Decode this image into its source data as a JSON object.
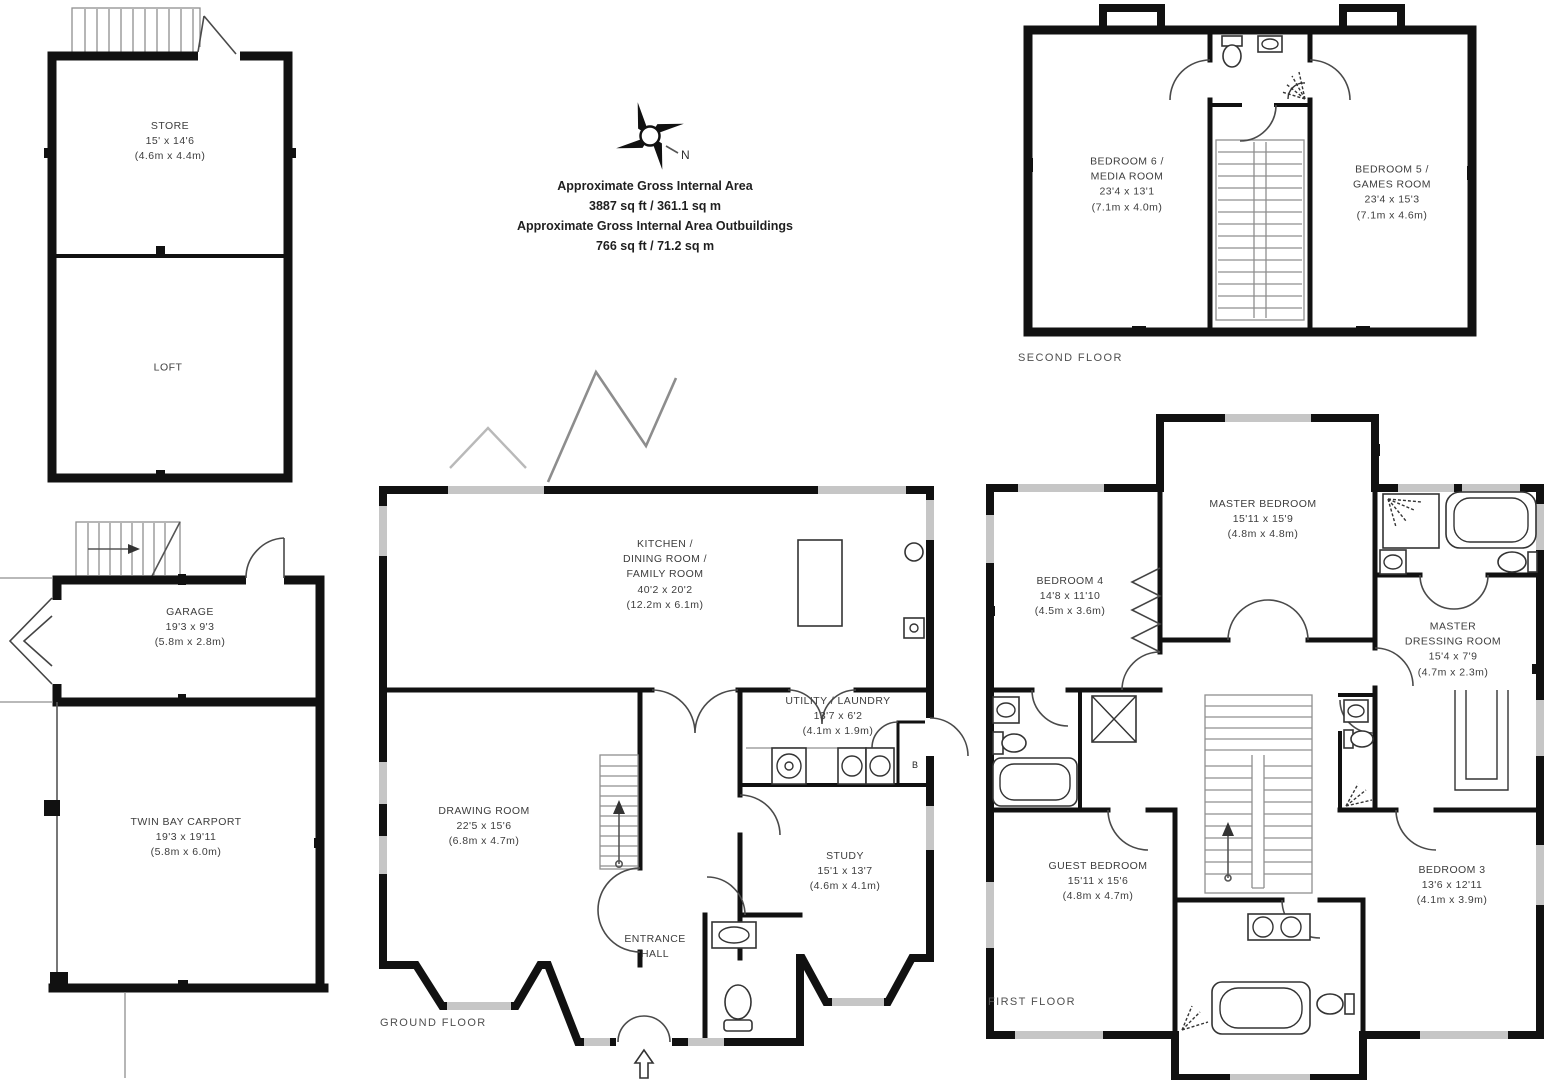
{
  "colors": {
    "wall": "#111111",
    "window": "#c6c6c6",
    "label_text": "#3d3d3d"
  },
  "compass": {
    "north_label": "N"
  },
  "area_summary": {
    "lines": [
      "Approximate Gross Internal Area",
      "3887 sq ft / 361.1 sq m",
      "Approximate Gross Internal Area Outbuildings",
      "766 sq ft / 71.2 sq m"
    ]
  },
  "floor_captions": {
    "ground": "GROUND FLOOR",
    "first": "FIRST FLOOR",
    "second": "SECOND FLOOR"
  },
  "fixtures": {
    "boiler_label": "B"
  },
  "rooms": {
    "store": {
      "lines": [
        "STORE",
        "15' x 14'6",
        "(4.6m x 4.4m)"
      ]
    },
    "loft": {
      "lines": [
        "LOFT"
      ]
    },
    "garage": {
      "lines": [
        "GARAGE",
        "19'3 x 9'3",
        "(5.8m x 2.8m)"
      ]
    },
    "carport": {
      "lines": [
        "TWIN BAY CARPORT",
        "19'3 x 19'11",
        "(5.8m x 6.0m)"
      ]
    },
    "kitchen": {
      "lines": [
        "KITCHEN /",
        "DINING ROOM /",
        "FAMILY ROOM",
        "40'2 x 20'2",
        "(12.2m x 6.1m)"
      ]
    },
    "drawing": {
      "lines": [
        "DRAWING ROOM",
        "22'5 x 15'6",
        "(6.8m x 4.7m)"
      ]
    },
    "utility": {
      "lines": [
        "UTILITY / LAUNDRY",
        "13'7 x 6'2",
        "(4.1m x 1.9m)"
      ]
    },
    "study": {
      "lines": [
        "STUDY",
        "15'1 x 13'7",
        "(4.6m x 4.1m)"
      ]
    },
    "hall": {
      "lines": [
        "ENTRANCE",
        "HALL"
      ]
    },
    "master": {
      "lines": [
        "MASTER BEDROOM",
        "15'11 x 15'9",
        "(4.8m x 4.8m)"
      ]
    },
    "bedroom4": {
      "lines": [
        "BEDROOM 4",
        "14'8 x 11'10",
        "(4.5m x 3.6m)"
      ]
    },
    "dressing": {
      "lines": [
        "MASTER",
        "DRESSING ROOM",
        "15'4 x 7'9",
        "(4.7m x 2.3m)"
      ]
    },
    "guest": {
      "lines": [
        "GUEST BEDROOM",
        "15'11 x 15'6",
        "(4.8m x 4.7m)"
      ]
    },
    "bedroom3": {
      "lines": [
        "BEDROOM 3",
        "13'6 x 12'11",
        "(4.1m x 3.9m)"
      ]
    },
    "bedroom6": {
      "lines": [
        "BEDROOM 6 /",
        "MEDIA ROOM",
        "23'4 x 13'1",
        "(7.1m x 4.0m)"
      ]
    },
    "bedroom5": {
      "lines": [
        "BEDROOM 5 /",
        "GAMES ROOM",
        "23'4 x 15'3",
        "(7.1m x 4.6m)"
      ]
    }
  }
}
